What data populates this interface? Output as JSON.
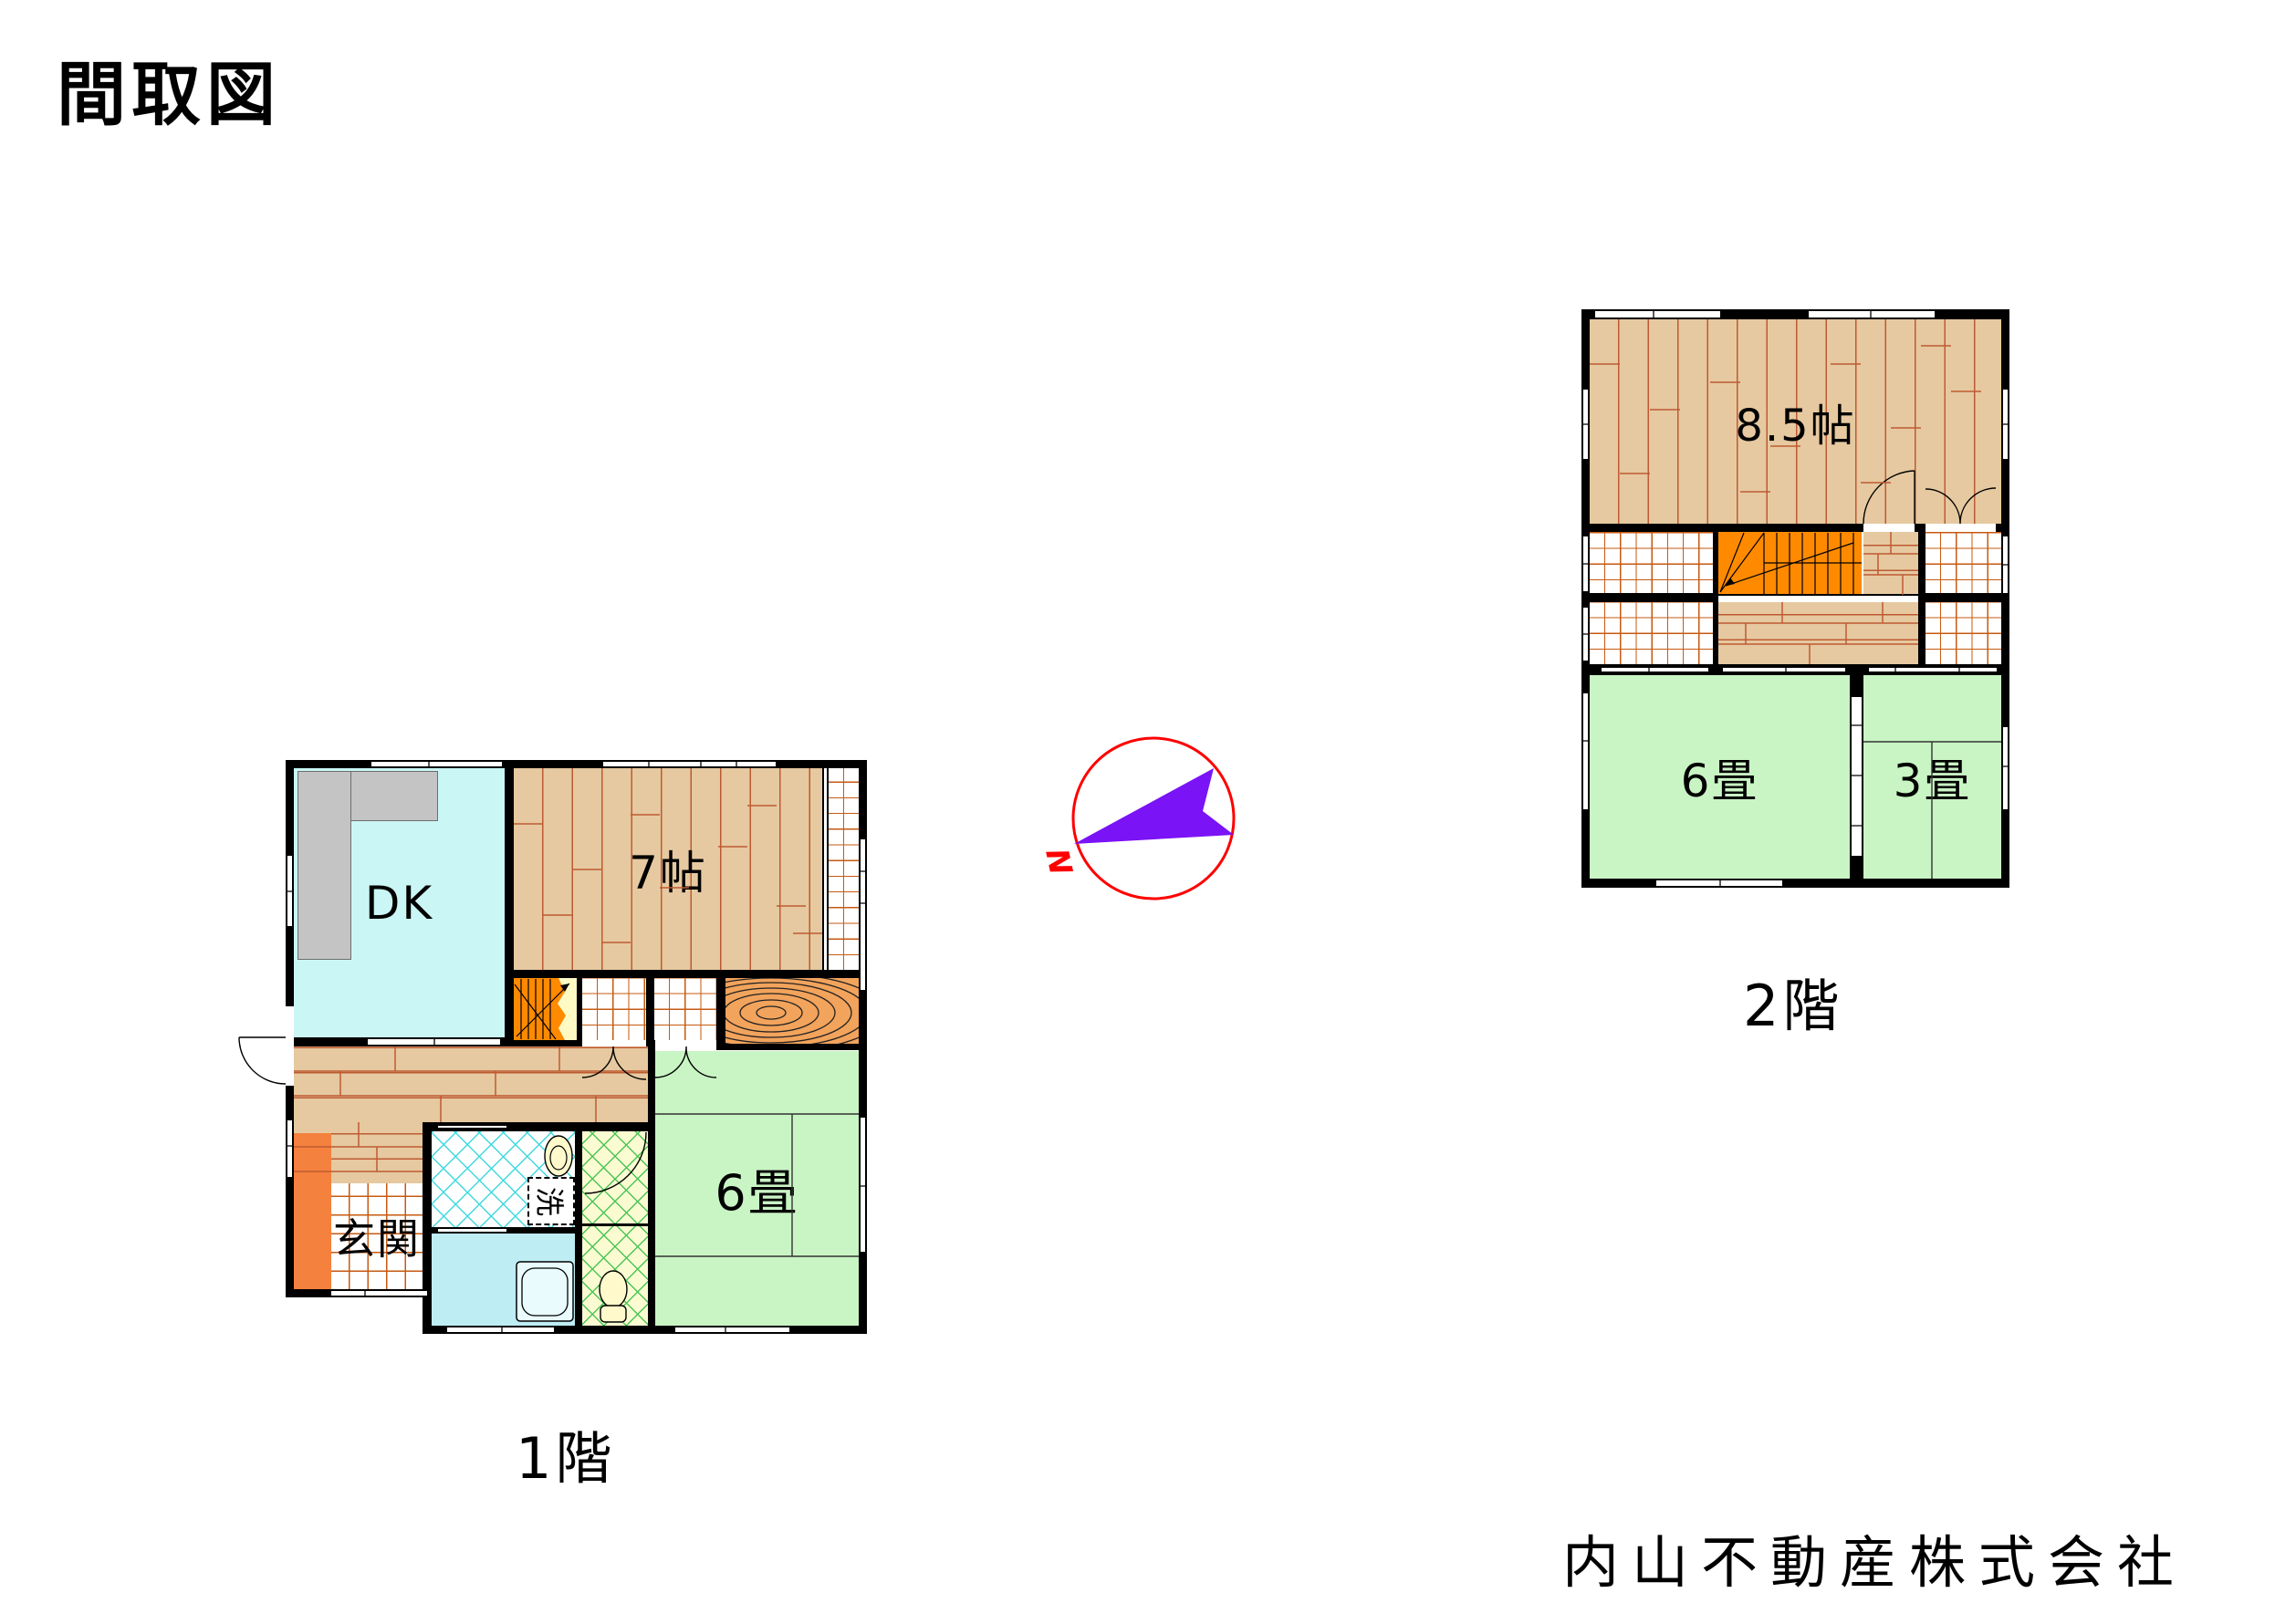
{
  "page": {
    "title": "間取図",
    "company": "内山不動産株式会社"
  },
  "floor1": {
    "caption": "1階",
    "rooms": {
      "dk": "DK",
      "western7": "7帖",
      "entrance": "玄関",
      "tatami6": "6畳",
      "laundry": "洗"
    }
  },
  "floor2": {
    "caption": "2階",
    "rooms": {
      "western85": "8.5帖",
      "tatami6": "6畳",
      "tatami3": "3畳"
    }
  },
  "compass": {
    "north": "N"
  },
  "colors": {
    "wall": "#000000",
    "wood_floor": "#E6C9A0",
    "plank_line": "#BE5A32",
    "tatami_green": "#C9F4C4",
    "dk_cyan": "#CAF7F6",
    "bath_cyan": "#BEEDF4",
    "stairs_orange": "#FF8A00",
    "entrance_step": "#F4813D",
    "grain_board": "#F2A35C",
    "tile_grid_line": "#C65A11",
    "hatch_cyan": "#3FD9DE",
    "hatch_green": "#4BC657",
    "toilet_bg": "#FBFBD2",
    "compass_ring": "#FF0000",
    "compass_arrow": "#7A13F5"
  }
}
